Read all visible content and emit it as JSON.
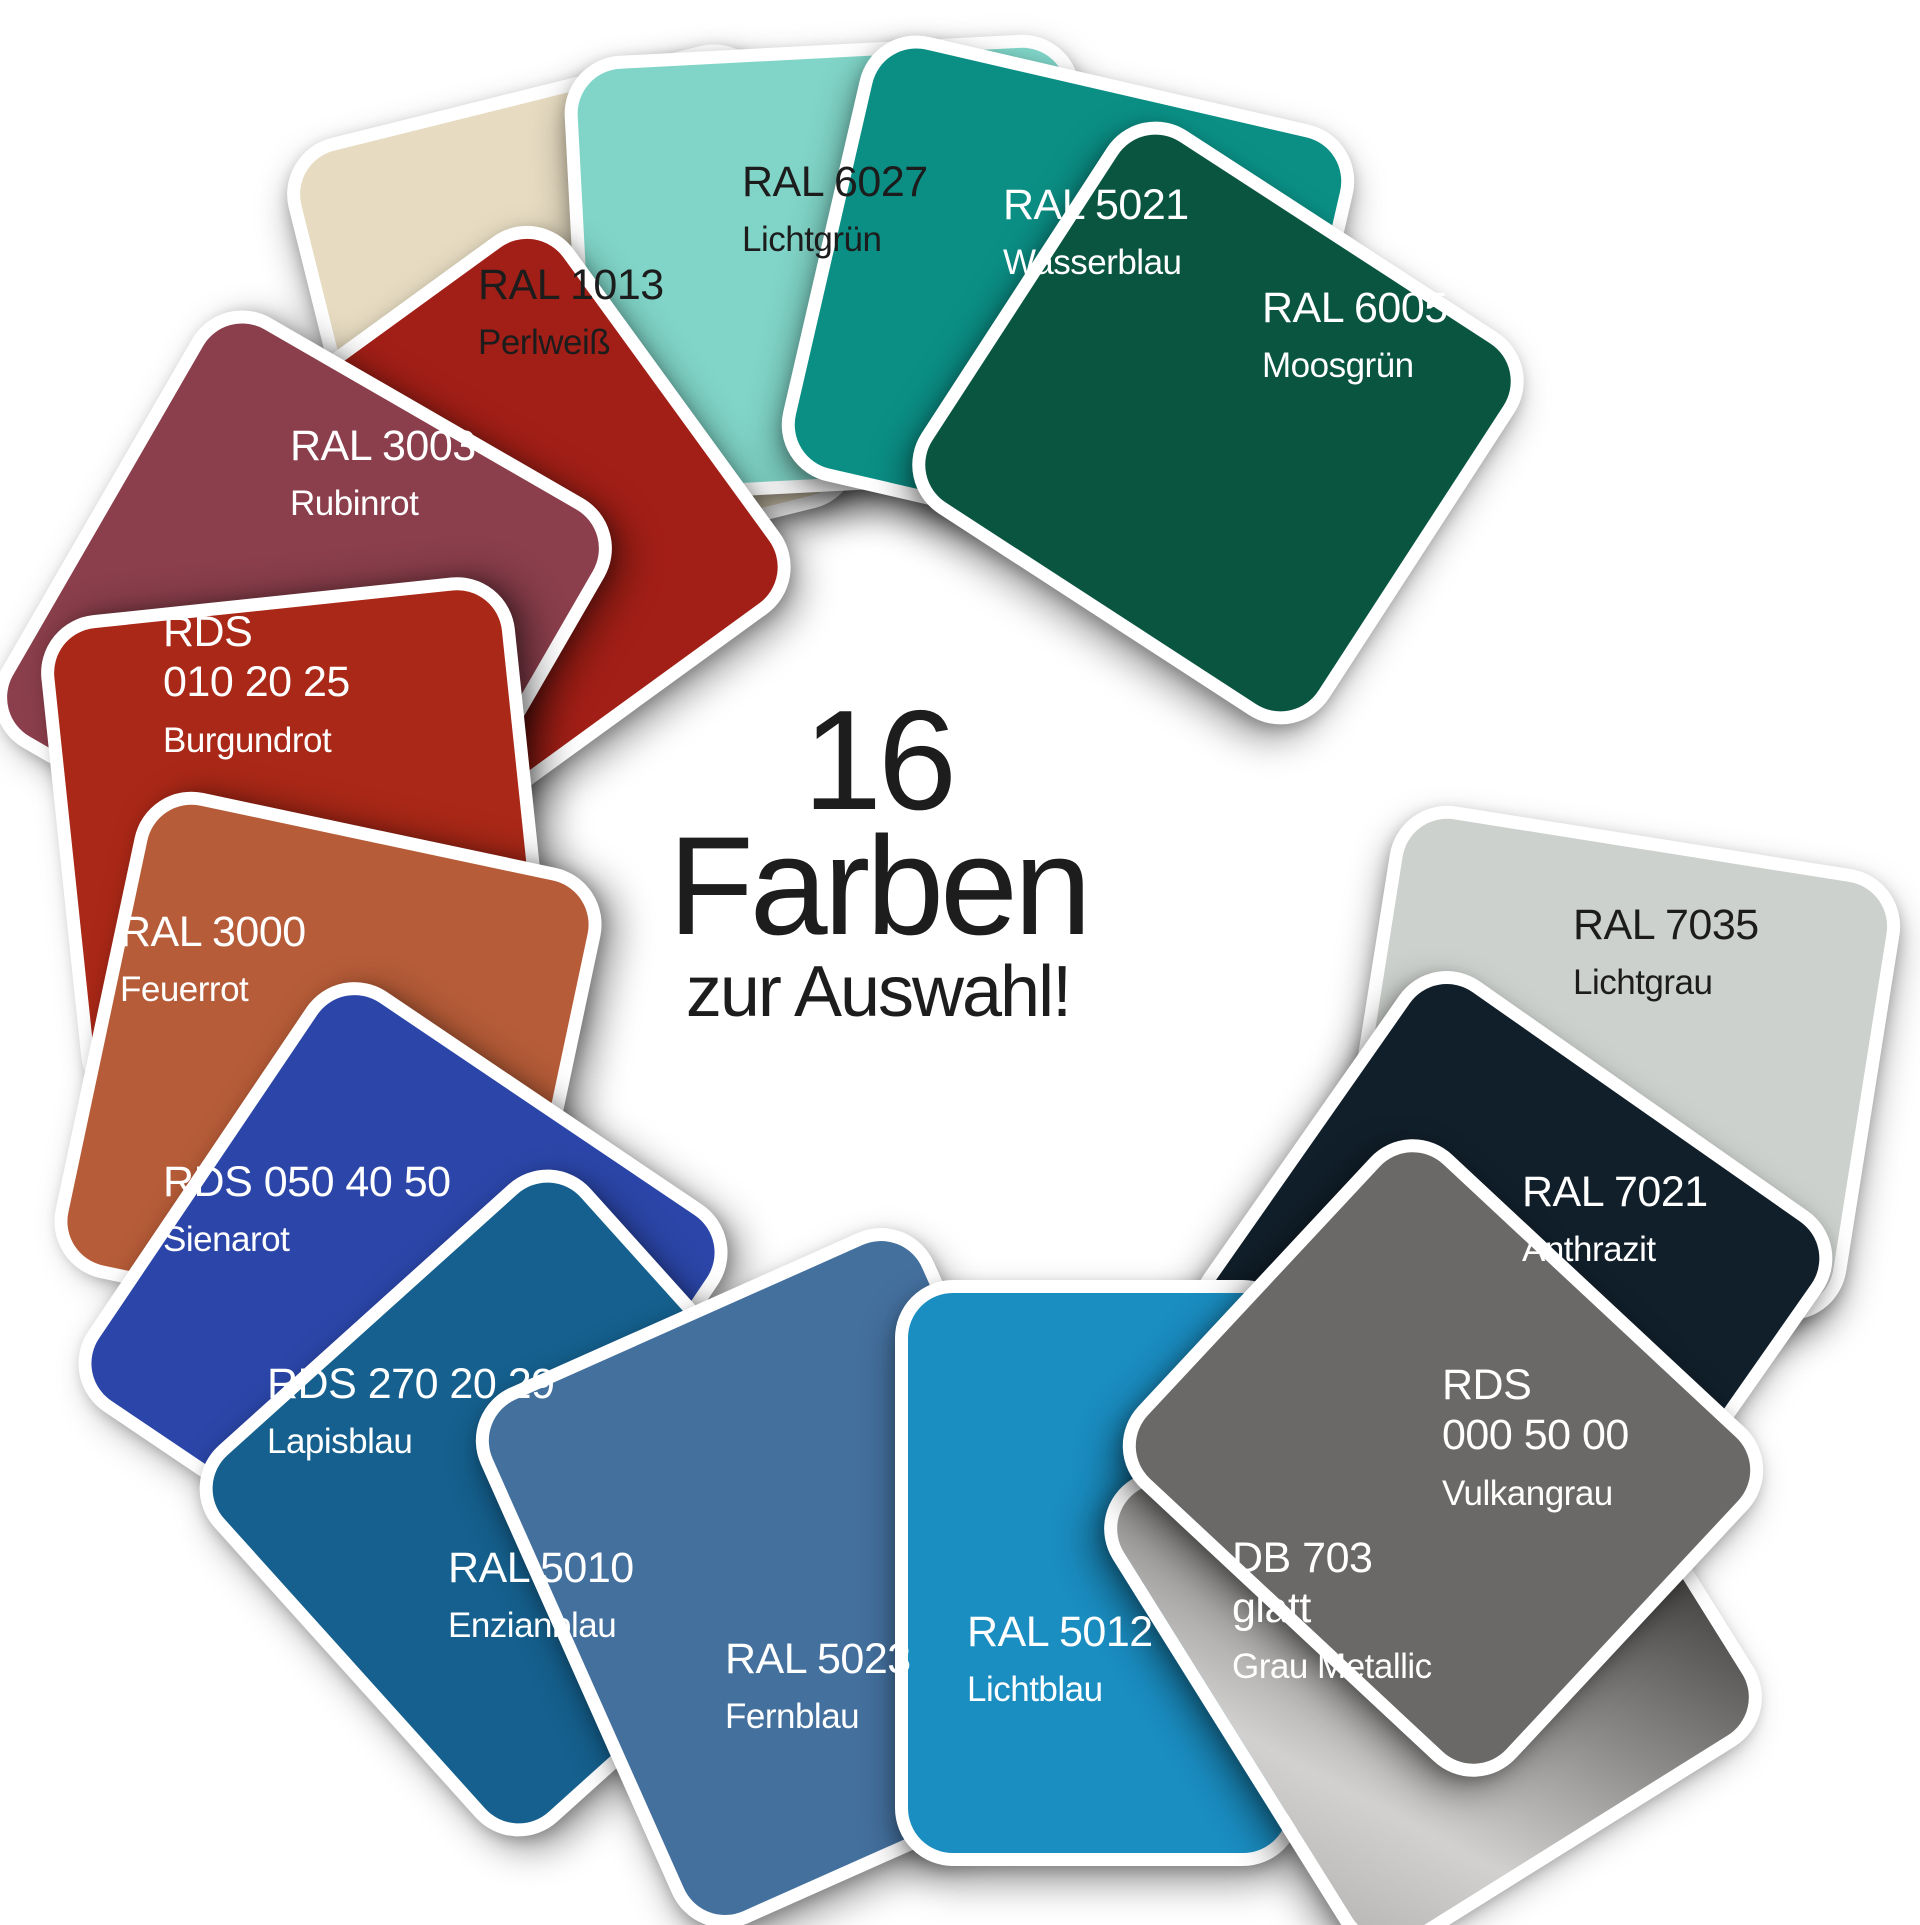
{
  "center": {
    "line1": "16",
    "line2": "Farben",
    "line3": "zur Auswahl!",
    "text_color": "#1d1d1d"
  },
  "swatches": [
    {
      "code": "RAL 1013",
      "name": "Perlweiß",
      "fill": "#e7dcc2",
      "text_color": "#1c1c1c"
    },
    {
      "code": "RAL 6027",
      "name": "Lichtgrün",
      "fill": "#80d5c8",
      "text_color": "#1c1c1c"
    },
    {
      "code": "RAL 5021",
      "name": "Wasserblau",
      "fill": "#0b8f85",
      "text_color": "#ffffff"
    },
    {
      "code": "RAL 6005",
      "name": "Moosgrün",
      "fill": "#0a5540",
      "text_color": "#ffffff"
    },
    {
      "code": "RAL 7035",
      "name": "Lichtgrau",
      "fill": "#cdd1cd",
      "text_color": "#1c1c1c"
    },
    {
      "code": "RAL 7021",
      "name": "Anthrazit",
      "fill": "#111f2a",
      "text_color": "#ffffff"
    },
    {
      "code": "RDS\n000 50 00",
      "name": "Vulkangrau",
      "fill": "#6a6967",
      "text_color": "#ffffff"
    },
    {
      "code": "DB 703\nglatt",
      "name": "Grau Metallic",
      "fill": "linear-gradient(150deg, #55544f 0%, #42413f 25%, #8c8b89 55%, #d2d1cf 80%, #b7b6b4 100%)",
      "text_color": "#ffffff"
    },
    {
      "code": "RAL 5012",
      "name": "Lichtblau",
      "fill": "#1a8dc1",
      "text_color": "#ffffff"
    },
    {
      "code": "RAL 5023",
      "name": "Fernblau",
      "fill": "#44709e",
      "text_color": "#ffffff"
    },
    {
      "code": "RAL 5010",
      "name": "Enzianblau",
      "fill": "#15608e",
      "text_color": "#ffffff"
    },
    {
      "code": "RDS 270 20 29",
      "name": "Lapisblau",
      "fill": "#2b46a8",
      "text_color": "#ffffff"
    },
    {
      "code": "RDS 050 40 50",
      "name": "Sienarot",
      "fill": "#b65c38",
      "text_color": "#ffffff"
    },
    {
      "code": "RAL 3000",
      "name": "Feuerrot",
      "fill": "#aa2817",
      "text_color": "#ffffff"
    },
    {
      "code": "RDS\n010 20 25",
      "name": "Burgundrot",
      "fill": "#8b3f4c",
      "text_color": "#ffffff"
    },
    {
      "code": "RAL 3003",
      "name": "Rubinrot",
      "fill": "#a21f17",
      "text_color": "#ffffff"
    }
  ]
}
